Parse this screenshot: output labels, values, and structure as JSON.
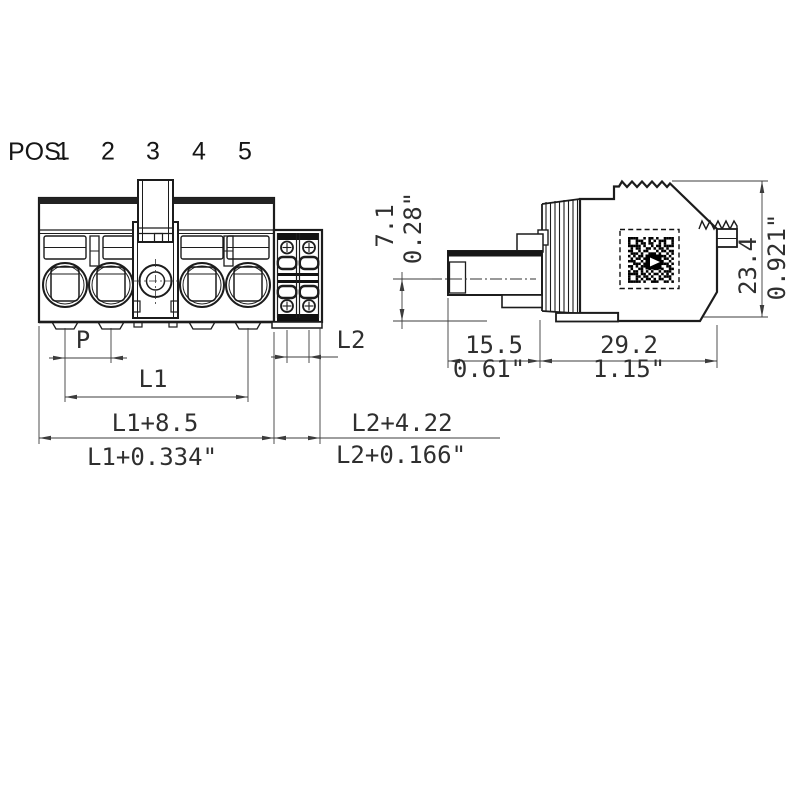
{
  "front_view": {
    "positions_label": "POS.",
    "position_numbers": [
      "1",
      "2",
      "3",
      "4",
      "5"
    ],
    "dim_pitch": "P",
    "dim_l1": "L1",
    "dim_l1_total_mm": "L1+8.5",
    "dim_l1_total_inch": "L1+0.334\"",
    "dim_l2": "L2",
    "dim_l2_total_mm": "L2+4.22",
    "dim_l2_total_inch": "L2+0.166\""
  },
  "side_view": {
    "dim_pin_height_mm": "7.1",
    "dim_pin_height_inch": "0.28\"",
    "dim_pin_length_mm": "15.5",
    "dim_pin_length_inch": "0.61\"",
    "dim_body_length_mm": "29.2",
    "dim_body_length_inch": "1.15\"",
    "dim_height_mm": "23.4",
    "dim_height_inch": "0.921\"",
    "qr_pattern": [
      "111100101101001111",
      "100111001010111001",
      "100101101100101001",
      "111110100101101111",
      "010110011010110100",
      "110010110001011011",
      "011101001110100101",
      "101011010010111010",
      "010110111101001101",
      "111001010110110010",
      "001110101001011101",
      "110101110110100110",
      "010011001011010011",
      "101101010100101110",
      "111101101011010101",
      "100110110100101110",
      "100101011010110010",
      "111110100111001101"
    ]
  },
  "colors": {
    "line": "#1c1c1c",
    "dim_line": "#3c3c3c",
    "dim_text": "#2f2f2f"
  }
}
